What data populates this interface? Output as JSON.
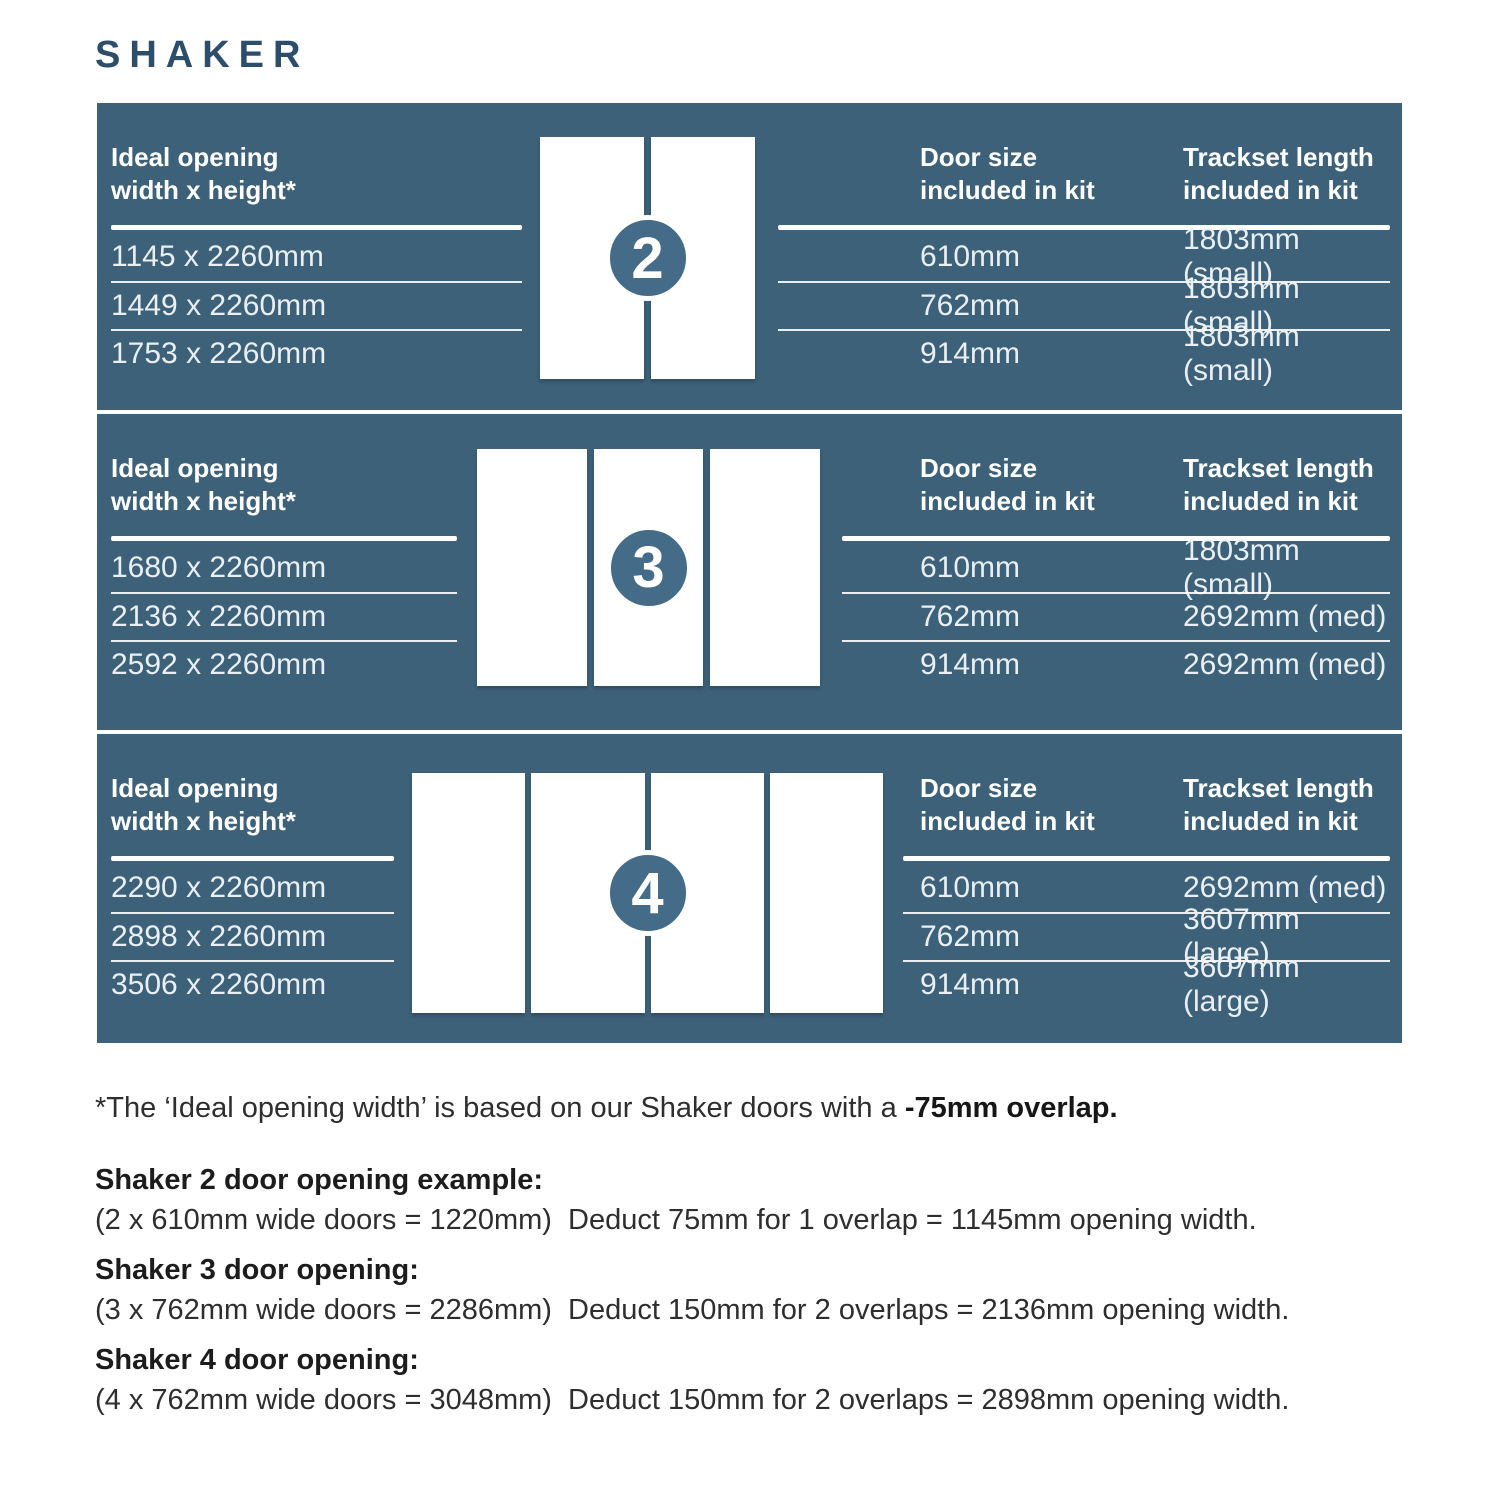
{
  "title": "SHAKER",
  "colors": {
    "panel-bg": "#3d6179",
    "badge-bg": "#446b87",
    "title-color": "#2d4e6b",
    "header-text": "#ffffff",
    "row-text": "#e9eff3",
    "footer-text": "#2e2e2e"
  },
  "column_headers": {
    "opening": "Ideal opening\nwidth x height*",
    "door_size": "Door size\nincluded in kit",
    "trackset": "Trackset length\nincluded in kit"
  },
  "sections": [
    {
      "badge": "2",
      "openings": [
        "1145 x 2260mm",
        "1449 x 2260mm",
        "1753 x 2260mm"
      ],
      "rows": [
        {
          "door_size": "610mm",
          "trackset": "1803mm (small)"
        },
        {
          "door_size": "762mm",
          "trackset": "1803mm (small)"
        },
        {
          "door_size": "914mm",
          "trackset": "1803mm (small)"
        }
      ]
    },
    {
      "badge": "3",
      "openings": [
        "1680 x 2260mm",
        "2136 x 2260mm",
        "2592 x 2260mm"
      ],
      "rows": [
        {
          "door_size": "610mm",
          "trackset": "1803mm (small)"
        },
        {
          "door_size": "762mm",
          "trackset": "2692mm (med)"
        },
        {
          "door_size": "914mm",
          "trackset": "2692mm (med)"
        }
      ]
    },
    {
      "badge": "4",
      "openings": [
        "2290 x 2260mm",
        "2898 x 2260mm",
        "3506 x 2260mm"
      ],
      "rows": [
        {
          "door_size": "610mm",
          "trackset": "2692mm (med)"
        },
        {
          "door_size": "762mm",
          "trackset": "3607mm (large)"
        },
        {
          "door_size": "914mm",
          "trackset": "3607mm (large)"
        }
      ]
    }
  ],
  "footnote": {
    "text": "*The ‘Ideal opening width’ is based on our Shaker doors with a ",
    "bold": "-75mm overlap."
  },
  "examples": [
    {
      "heading": "Shaker 2 door opening example:",
      "detail": "(2 x 610mm wide doors = 1220mm)  Deduct 75mm for 1 overlap = 1145mm opening width."
    },
    {
      "heading": "Shaker 3 door opening:",
      "detail": "(3 x 762mm wide doors = 2286mm)  Deduct 150mm for 2 overlaps = 2136mm opening width."
    },
    {
      "heading": "Shaker 4 door opening:",
      "detail": "(4 x 762mm wide doors = 3048mm)  Deduct 150mm for 2 overlaps = 2898mm opening width."
    }
  ]
}
